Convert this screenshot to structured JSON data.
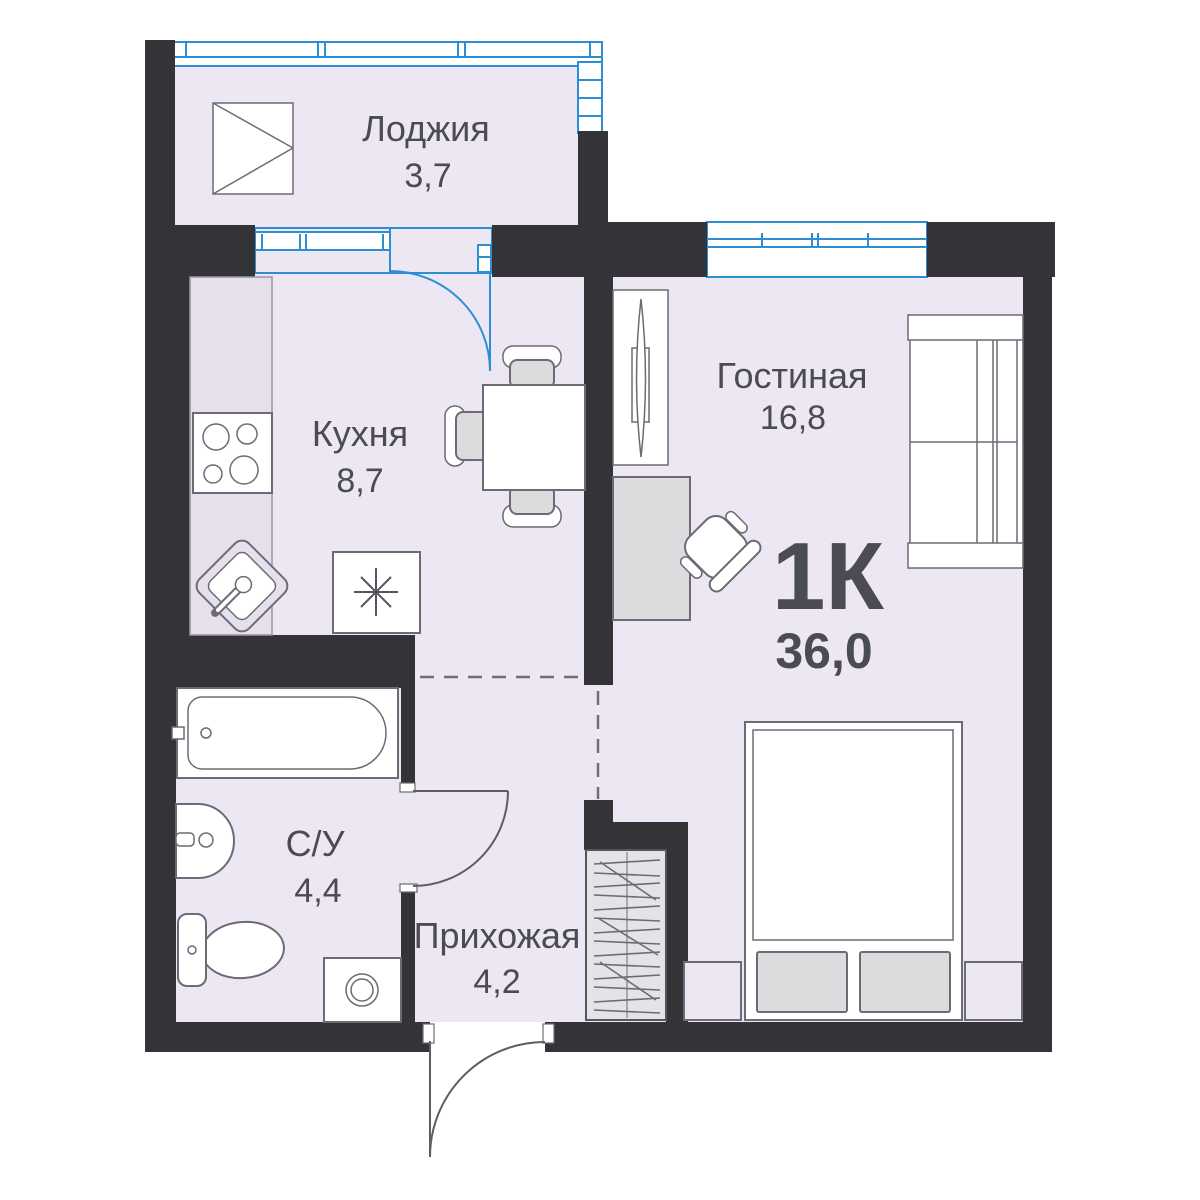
{
  "plan": {
    "type_label": "1К",
    "total_area": "36,0",
    "rooms": [
      {
        "id": "loggia",
        "name": "Лоджия",
        "area": "3,7"
      },
      {
        "id": "kitchen",
        "name": "Кухня",
        "area": "8,7"
      },
      {
        "id": "living",
        "name": "Гостиная",
        "area": "16,8"
      },
      {
        "id": "bathroom",
        "name": "С/У",
        "area": "4,4"
      },
      {
        "id": "hallway",
        "name": "Прихожая",
        "area": "4,2"
      }
    ],
    "colors": {
      "wall": "#333338",
      "floor": "#ece7f3",
      "glazing": "#2d8fd3",
      "text": "#4b4b55",
      "furniture_stroke": "#6b6b75",
      "counter": "#e6e0ec",
      "furniture_fill": "#dcdcdf"
    }
  }
}
